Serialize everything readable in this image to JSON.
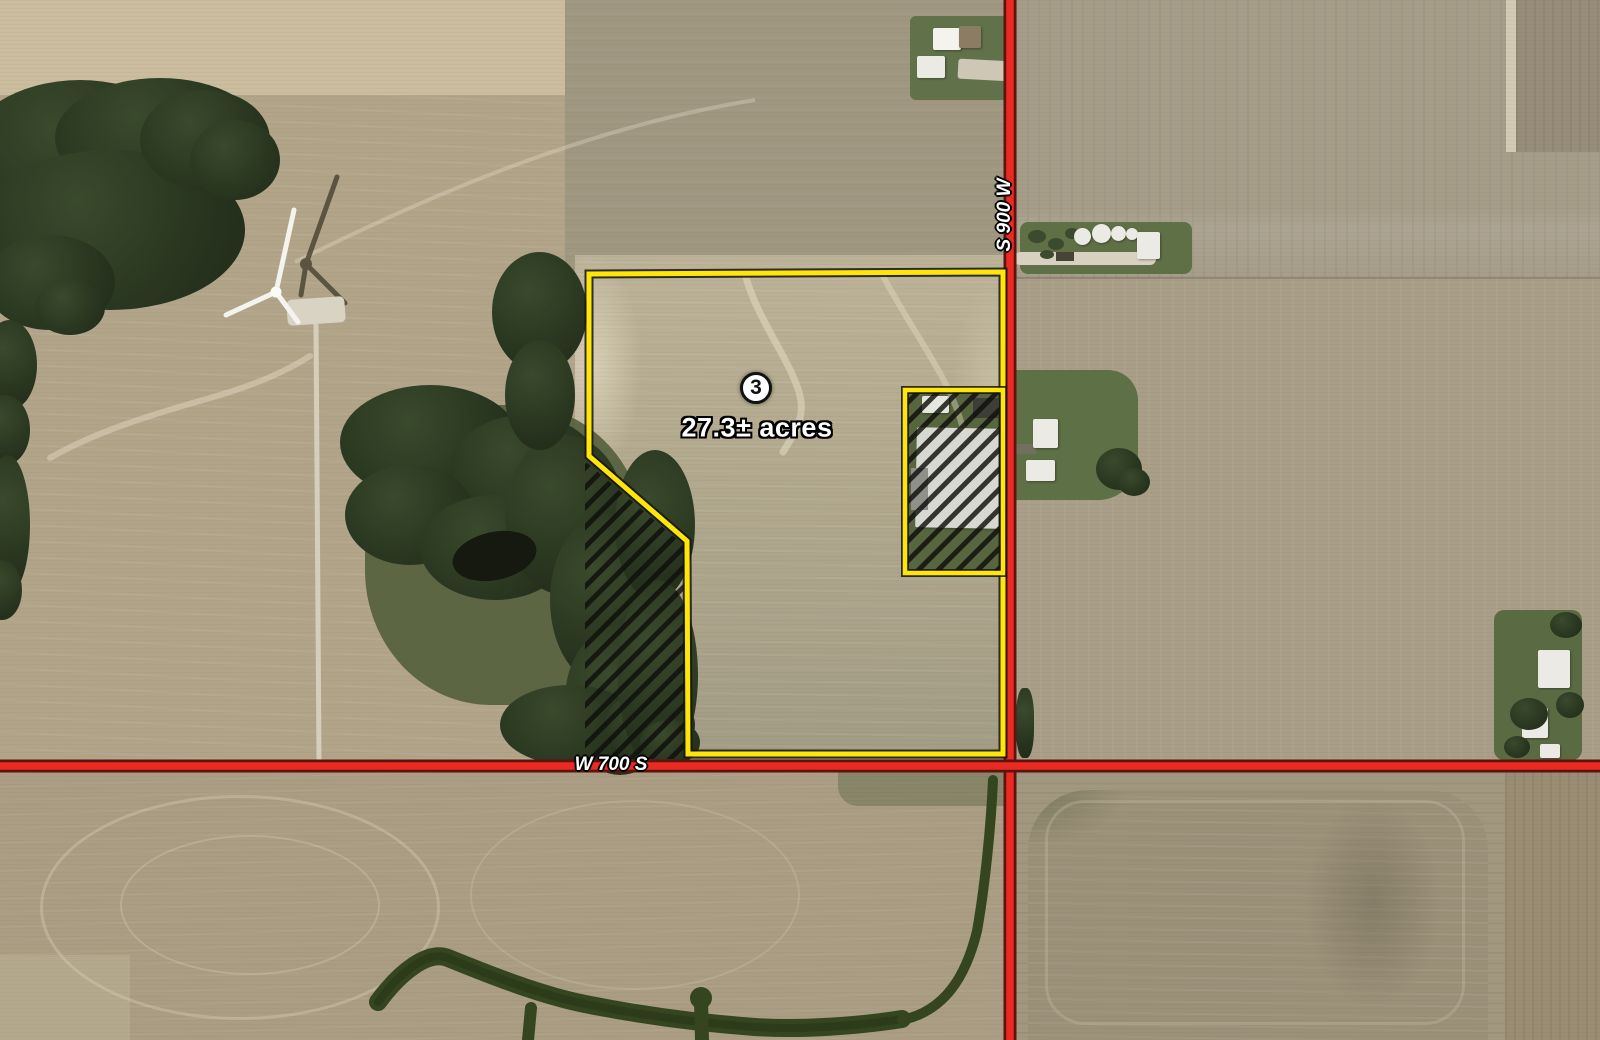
{
  "map": {
    "kind": "aerial-satellite-auction-tract-map",
    "tract": {
      "number": "3",
      "acreage": "27.3± acres",
      "boundary_color": "#ffe608",
      "exclusion_hatch_style": "black-diagonal-stripes"
    },
    "roads": {
      "north_south": {
        "label": "S 900 W",
        "color": "#e92b22"
      },
      "east_west": {
        "label": "W 700 S",
        "color": "#e92b22"
      }
    },
    "features": {
      "wind_turbine": "wind-turbine-with-shadow",
      "excluded_areas": [
        "hatched-farmstead-parcel",
        "hatched-wooded-strip"
      ],
      "waterway": "grassed-waterway"
    }
  }
}
